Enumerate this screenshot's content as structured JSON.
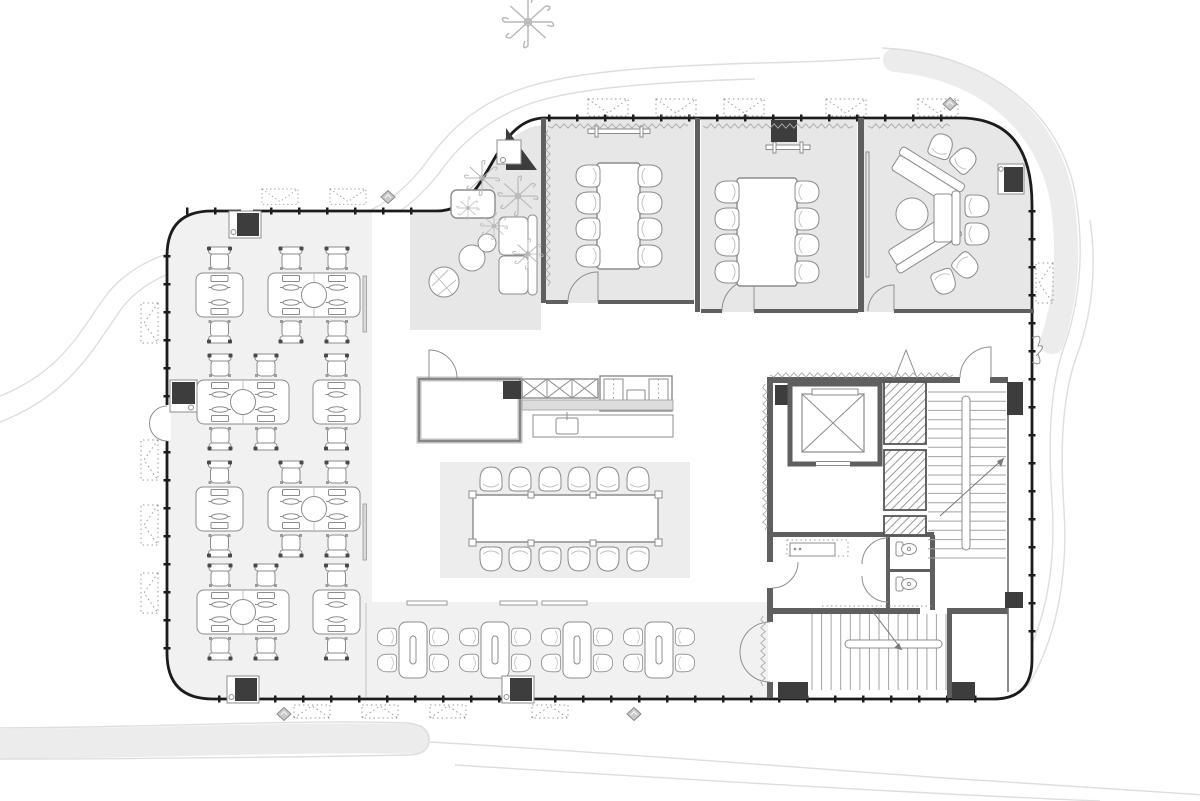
{
  "colors": {
    "bg": "#ffffff",
    "wall": "#1c1c1c",
    "wall2": "#5f5f5f",
    "dark": "#3d3d3d",
    "line": "#8c8c8c",
    "line_light": "#bdbdbd",
    "floor_light": "#f1f1f1",
    "floor_mid": "#e7e7e7",
    "rug": "#ededed",
    "hatch": "#9a9a9a",
    "site_band": "#ececec",
    "site_line": "#dedede"
  },
  "plan": {
    "type": "office-floor-plan",
    "rooms": [
      {
        "name": "open-office",
        "workstation_clusters": 8,
        "desk_seats": 24
      },
      {
        "name": "reception-lounge",
        "sofas": 1,
        "poufs": 2,
        "plants": 5
      },
      {
        "name": "meeting-room-1",
        "table_seats": 8,
        "wall_shelf": true
      },
      {
        "name": "meeting-room-2",
        "table_seats": 8,
        "wall_tv": true
      },
      {
        "name": "lounge-meeting-room",
        "angled_sofas": 2,
        "side_chairs": 6,
        "round_table": 1
      },
      {
        "name": "pantry-kitchen",
        "hatched_cabinets": 3,
        "island_sink": 1
      },
      {
        "name": "long-table-area",
        "table_seats": 12
      },
      {
        "name": "cafe",
        "tables": 4,
        "seats": 16
      },
      {
        "name": "elevator",
        "marked_with": "x-cross"
      },
      {
        "name": "stair-north",
        "treads": 19
      },
      {
        "name": "stair-south",
        "treads": 15
      },
      {
        "name": "wc",
        "toilets": 2
      },
      {
        "name": "storage",
        "counter": true
      }
    ],
    "stamps": [
      {
        "s": "desk2",
        "x": 196,
        "y": 273
      },
      {
        "s": "desk4",
        "x": 268,
        "y": 273
      },
      {
        "s": "desk4",
        "x": 197,
        "y": 380
      },
      {
        "s": "desk2",
        "x": 313,
        "y": 380
      },
      {
        "s": "desk2",
        "x": 196,
        "y": 487
      },
      {
        "s": "desk4",
        "x": 268,
        "y": 487
      },
      {
        "s": "desk4",
        "x": 197,
        "y": 590
      },
      {
        "s": "desk2",
        "x": 313,
        "y": 590
      },
      {
        "s": "cafe-table",
        "x": 413,
        "y": 650
      },
      {
        "s": "cafe-table",
        "x": 495,
        "y": 650
      },
      {
        "s": "cafe-table",
        "x": 577,
        "y": 650
      },
      {
        "s": "cafe-table",
        "x": 659,
        "y": 650
      },
      {
        "s": "tchair",
        "x": 588,
        "y": 176,
        "r": -90
      },
      {
        "s": "tchair",
        "x": 588,
        "y": 203,
        "r": -90
      },
      {
        "s": "tchair",
        "x": 588,
        "y": 229,
        "r": -90
      },
      {
        "s": "tchair",
        "x": 588,
        "y": 256,
        "r": -90
      },
      {
        "s": "tchair",
        "x": 650,
        "y": 176,
        "r": 90
      },
      {
        "s": "tchair",
        "x": 650,
        "y": 203,
        "r": 90
      },
      {
        "s": "tchair",
        "x": 650,
        "y": 229,
        "r": 90
      },
      {
        "s": "tchair",
        "x": 650,
        "y": 256,
        "r": 90
      },
      {
        "s": "tchair",
        "x": 727,
        "y": 192,
        "r": -90
      },
      {
        "s": "tchair",
        "x": 727,
        "y": 219,
        "r": -90
      },
      {
        "s": "tchair",
        "x": 727,
        "y": 245,
        "r": -90
      },
      {
        "s": "tchair",
        "x": 727,
        "y": 272,
        "r": -90
      },
      {
        "s": "tchair",
        "x": 807,
        "y": 192,
        "r": 90
      },
      {
        "s": "tchair",
        "x": 807,
        "y": 219,
        "r": 90
      },
      {
        "s": "tchair",
        "x": 807,
        "y": 245,
        "r": 90
      },
      {
        "s": "tchair",
        "x": 807,
        "y": 272,
        "r": 90
      },
      {
        "s": "tchair",
        "x": 491,
        "y": 479
      },
      {
        "s": "tchair",
        "x": 520,
        "y": 479
      },
      {
        "s": "tchair",
        "x": 550,
        "y": 479
      },
      {
        "s": "tchair",
        "x": 579,
        "y": 479
      },
      {
        "s": "tchair",
        "x": 608,
        "y": 479
      },
      {
        "s": "tchair",
        "x": 638,
        "y": 479
      },
      {
        "s": "tchair",
        "x": 491,
        "y": 559,
        "r": 180
      },
      {
        "s": "tchair",
        "x": 520,
        "y": 559,
        "r": 180
      },
      {
        "s": "tchair",
        "x": 550,
        "y": 559,
        "r": 180
      },
      {
        "s": "tchair",
        "x": 579,
        "y": 559,
        "r": 180
      },
      {
        "s": "tchair",
        "x": 608,
        "y": 559,
        "r": 180
      },
      {
        "s": "tchair",
        "x": 638,
        "y": 559,
        "r": 180
      },
      {
        "s": "tchair",
        "x": 941,
        "y": 146,
        "r": 20
      },
      {
        "s": "tchair",
        "x": 964,
        "y": 160,
        "r": 45
      },
      {
        "s": "tchair",
        "x": 944,
        "y": 282,
        "r": 160
      },
      {
        "s": "tchair",
        "x": 966,
        "y": 266,
        "r": 135
      },
      {
        "s": "tchair",
        "x": 977,
        "y": 206,
        "r": 90
      },
      {
        "s": "tchair",
        "x": 977,
        "y": 234,
        "r": 90
      },
      {
        "s": "toilet",
        "x": 906,
        "y": 549
      },
      {
        "s": "toilet",
        "x": 906,
        "y": 584
      },
      {
        "s": "winh",
        "x": 588,
        "y": 99
      },
      {
        "s": "winh",
        "x": 656,
        "y": 99
      },
      {
        "s": "winh",
        "x": 724,
        "y": 99
      },
      {
        "s": "winh",
        "x": 826,
        "y": 99
      },
      {
        "s": "winh",
        "x": 918,
        "y": 99
      },
      {
        "s": "winh",
        "x": 262,
        "y": 189,
        "k": 0.9
      },
      {
        "s": "winh",
        "x": 330,
        "y": 189,
        "k": 0.9
      },
      {
        "s": "winh",
        "x": 158,
        "y": 303,
        "r": 90
      },
      {
        "s": "winh",
        "x": 158,
        "y": 440,
        "r": 90
      },
      {
        "s": "winh",
        "x": 158,
        "y": 505,
        "r": 90
      },
      {
        "s": "winh",
        "x": 158,
        "y": 573,
        "r": 90
      },
      {
        "s": "winh",
        "x": 1053,
        "y": 263,
        "r": 90
      },
      {
        "s": "winb",
        "x": 294,
        "y": 705
      },
      {
        "s": "winb",
        "x": 362,
        "y": 705
      },
      {
        "s": "winb",
        "x": 430,
        "y": 705
      },
      {
        "s": "winb",
        "x": 532,
        "y": 705
      },
      {
        "s": "ac",
        "x": 229,
        "y": 211
      },
      {
        "s": "ac",
        "x": 170,
        "y": 412,
        "r": -90
      },
      {
        "s": "ac",
        "x": 227,
        "y": 676
      },
      {
        "s": "ac",
        "x": 502,
        "y": 676
      },
      {
        "s": "dia",
        "x": 388,
        "y": 197
      },
      {
        "s": "dia",
        "x": 950,
        "y": 104
      },
      {
        "s": "dia",
        "x": 284,
        "y": 714
      },
      {
        "s": "dia",
        "x": 634,
        "y": 714
      },
      {
        "s": "plant",
        "x": 482,
        "y": 178,
        "k": 1.1
      },
      {
        "s": "plant",
        "x": 518,
        "y": 196,
        "k": 1.25
      },
      {
        "s": "plant",
        "x": 494,
        "y": 226,
        "k": 0.85
      },
      {
        "s": "plant",
        "x": 528,
        "y": 254,
        "k": 0.95
      },
      {
        "s": "plant",
        "x": 468,
        "y": 208,
        "k": 0.7
      },
      {
        "s": "plant",
        "x": 528,
        "y": 22,
        "k": 1.6
      }
    ],
    "stairs": [
      {
        "g": "stairN",
        "dir": "h",
        "x1": 928,
        "x2": 1006,
        "y1": 392,
        "y2": 558,
        "n": 19
      },
      {
        "g": "stairS",
        "dir": "v",
        "x1": 812,
        "x2": 946,
        "y1": 614,
        "y2": 690,
        "n": 15
      }
    ],
    "zigzags": [
      [
        548,
        126,
        688,
        126
      ],
      [
        703,
        126,
        853,
        126
      ],
      [
        868,
        126,
        950,
        126
      ],
      [
        548,
        130,
        548,
        286
      ],
      [
        770,
        375,
        953,
        375
      ],
      [
        765,
        384,
        765,
        530
      ],
      [
        763,
        616,
        763,
        686
      ]
    ],
    "dotted_paths": [
      [
        822,
        606,
        934,
        606
      ]
    ]
  }
}
